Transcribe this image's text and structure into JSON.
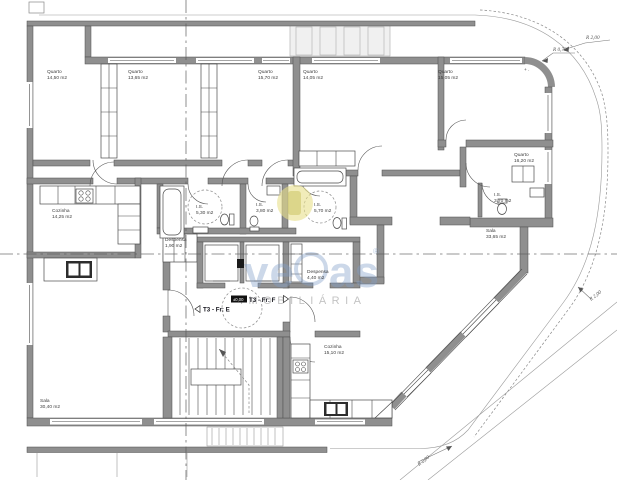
{
  "page": {
    "background": "#ffffff"
  },
  "plan": {
    "watermark": {
      "brand_left": "ve",
      "brand_right": "as",
      "registered": "®",
      "subtitle": "IMOBILIÁRIA"
    },
    "apartments": [
      {
        "label": "T3 - Fr: E"
      },
      {
        "label": "T3 - Fr: F"
      }
    ],
    "level_marker": {
      "value": "±0,00"
    },
    "rooms": [
      {
        "name": "Quarto",
        "area": "14,50 m2"
      },
      {
        "name": "Quarto",
        "area": "13,65 m2"
      },
      {
        "name": "Quarto",
        "area": "15,70 m2"
      },
      {
        "name": "Quarto",
        "area": "14,05 m2"
      },
      {
        "name": "Quarto",
        "area": "15,05 m2"
      },
      {
        "name": "Quarto",
        "area": "16,20 m2"
      },
      {
        "name": "Cozinha",
        "area": "14,25 m2"
      },
      {
        "name": "Despensa",
        "area": "1,90 m2"
      },
      {
        "name": "I.S.",
        "area": "5,30 m2"
      },
      {
        "name": "I.S.",
        "area": "3,80 m2"
      },
      {
        "name": "I.S.",
        "area": "5,70 m2"
      },
      {
        "name": "I.S.",
        "area": "3,70 m2"
      },
      {
        "name": "Sala",
        "area": "30,40 m2"
      },
      {
        "name": "Sala",
        "area": "33,65 m2"
      },
      {
        "name": "Despensa",
        "area": "4,40 m2"
      },
      {
        "name": "Cozinha",
        "area": "15,10 m2"
      }
    ],
    "annotations": {
      "radius_top": "R 2,00",
      "radius_corner": "R 0,70",
      "radius_right": "R 2,00",
      "radius_bottom": "R 2,00",
      "corner_marks": "+ ."
    },
    "colors": {
      "wall": "#8f8f8f",
      "line": "#4f4f4f",
      "centerline": "#5a5a5a",
      "watermark_blue": "#80a0c8",
      "watermark_yellow": "#e8e08a"
    }
  }
}
